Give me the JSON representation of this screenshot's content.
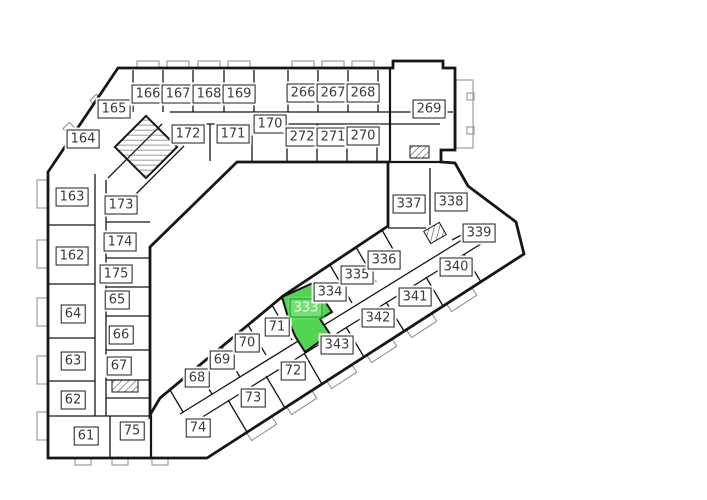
{
  "plan": {
    "selected_room": "333",
    "colors": {
      "background": "#ffffff",
      "wall": "#161616",
      "label_bg": "#ffffff",
      "label_border": "#1c1c1c",
      "label_text": "#3a3a3a",
      "highlight_fill": "#52d452",
      "highlight_label_bg": "#72df72",
      "highlight_border": "#13a013",
      "highlight_label_text": "#e9fbe9",
      "annex": "#9e9e9e"
    },
    "rooms": [
      {
        "label": "164",
        "x": 83,
        "y": 139
      },
      {
        "label": "165",
        "x": 114,
        "y": 109
      },
      {
        "label": "166",
        "x": 148,
        "y": 94
      },
      {
        "label": "167",
        "x": 178,
        "y": 94
      },
      {
        "label": "168",
        "x": 209,
        "y": 94
      },
      {
        "label": "169",
        "x": 239,
        "y": 94
      },
      {
        "label": "172",
        "x": 188,
        "y": 134
      },
      {
        "label": "171",
        "x": 233,
        "y": 134
      },
      {
        "label": "170",
        "x": 270,
        "y": 124
      },
      {
        "label": "266",
        "x": 303,
        "y": 93
      },
      {
        "label": "267",
        "x": 333,
        "y": 93
      },
      {
        "label": "268",
        "x": 363,
        "y": 93
      },
      {
        "label": "272",
        "x": 302,
        "y": 137
      },
      {
        "label": "271",
        "x": 333,
        "y": 137
      },
      {
        "label": "270",
        "x": 363,
        "y": 136
      },
      {
        "label": "269",
        "x": 429,
        "y": 109
      },
      {
        "label": "163",
        "x": 72,
        "y": 197
      },
      {
        "label": "173",
        "x": 121,
        "y": 205
      },
      {
        "label": "174",
        "x": 120,
        "y": 242
      },
      {
        "label": "162",
        "x": 72,
        "y": 256
      },
      {
        "label": "175",
        "x": 116,
        "y": 274
      },
      {
        "label": "65",
        "x": 117,
        "y": 300
      },
      {
        "label": "64",
        "x": 73,
        "y": 314
      },
      {
        "label": "66",
        "x": 121,
        "y": 335
      },
      {
        "label": "63",
        "x": 73,
        "y": 361
      },
      {
        "label": "67",
        "x": 119,
        "y": 366
      },
      {
        "label": "62",
        "x": 73,
        "y": 400
      },
      {
        "label": "61",
        "x": 86,
        "y": 436
      },
      {
        "label": "75",
        "x": 132,
        "y": 431
      },
      {
        "label": "68",
        "x": 197,
        "y": 378
      },
      {
        "label": "69",
        "x": 222,
        "y": 360
      },
      {
        "label": "70",
        "x": 247,
        "y": 343
      },
      {
        "label": "71",
        "x": 277,
        "y": 327
      },
      {
        "label": "74",
        "x": 198,
        "y": 428
      },
      {
        "label": "73",
        "x": 253,
        "y": 398
      },
      {
        "label": "72",
        "x": 293,
        "y": 371
      },
      {
        "label": "333",
        "x": 306,
        "y": 308,
        "highlighted": true
      },
      {
        "label": "334",
        "x": 330,
        "y": 292
      },
      {
        "label": "335",
        "x": 357,
        "y": 275
      },
      {
        "label": "336",
        "x": 384,
        "y": 260
      },
      {
        "label": "343",
        "x": 337,
        "y": 345
      },
      {
        "label": "342",
        "x": 378,
        "y": 318
      },
      {
        "label": "341",
        "x": 415,
        "y": 297
      },
      {
        "label": "340",
        "x": 456,
        "y": 267
      },
      {
        "label": "339",
        "x": 479,
        "y": 233
      },
      {
        "label": "338",
        "x": 451,
        "y": 202
      },
      {
        "label": "337",
        "x": 409,
        "y": 204
      }
    ]
  }
}
